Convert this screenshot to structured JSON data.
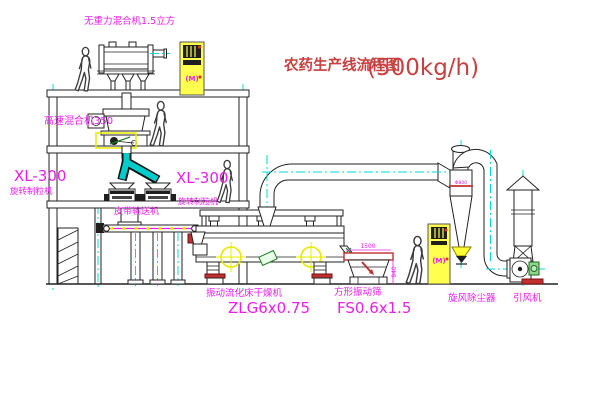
{
  "title": {
    "name": "农药生产线流程图",
    "capacity": "(500kg/h)"
  },
  "equipment": {
    "gravity_mixer": {
      "label": "无重力混合机1.5立方"
    },
    "high_speed_mixer": {
      "label": "高速混合机350"
    },
    "granulator_left": {
      "model": "XL-300",
      "name": "旋转制粒机"
    },
    "granulator_right": {
      "model": "XL-300",
      "name": "旋转制粒机"
    },
    "belt_conveyor": {
      "label": "皮带输送机"
    },
    "dryer": {
      "name": "振动流化床干燥机",
      "model": "ZLG6x0.75"
    },
    "sieve": {
      "name": "方形振动筛",
      "model": "FS0.6x1.5",
      "dim_width": "1500",
      "dim_height": "940"
    },
    "cyclone": {
      "name": "旋风除尘器",
      "dim": "Φ800"
    },
    "fan": {
      "name": "引风机"
    },
    "control_cabinet": {
      "symbol": "(M)"
    }
  },
  "colors": {
    "label_magenta": "#e820e8",
    "title_red": "#c84040",
    "line": "#222222",
    "centerline_cyan": "#00d8d8",
    "highlight_yellow": "#ffff4d",
    "status_red": "#c03030",
    "machine_green": "#1c7a1c"
  }
}
